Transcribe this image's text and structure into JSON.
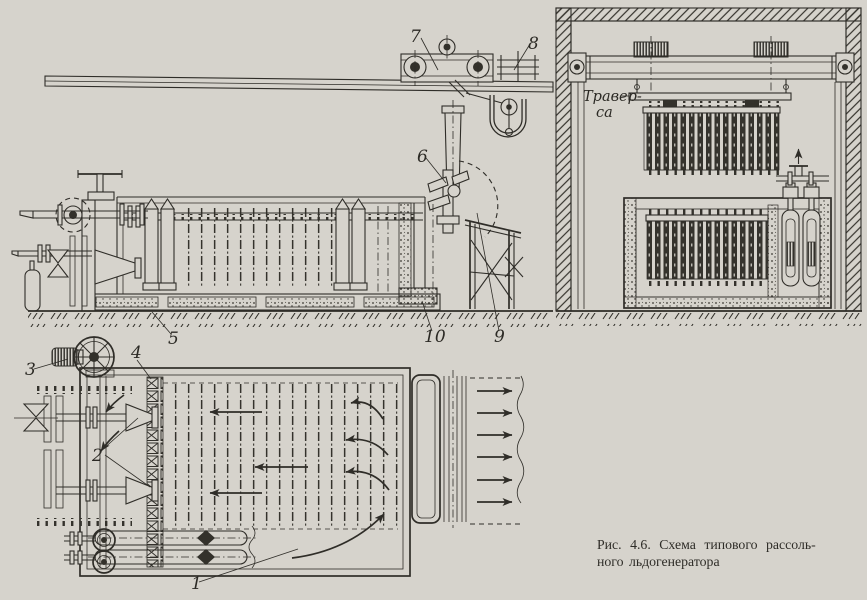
{
  "figure": {
    "caption": {
      "line1": "Рис. 4.6. Схема типового рассоль-",
      "line2": "ного льдогенератора"
    }
  },
  "annotations": {
    "traverse": {
      "line1": "Травер-",
      "line2": "са"
    }
  },
  "callouts": {
    "c1": "1",
    "c2": "2",
    "c3": "3",
    "c4": "4",
    "c5": "5",
    "c6": "6",
    "c7": "7",
    "c8": "8",
    "c9": "9",
    "c10": "10"
  },
  "colors": {
    "paper": "#d6d3cc",
    "ink": "#2f2d28"
  }
}
